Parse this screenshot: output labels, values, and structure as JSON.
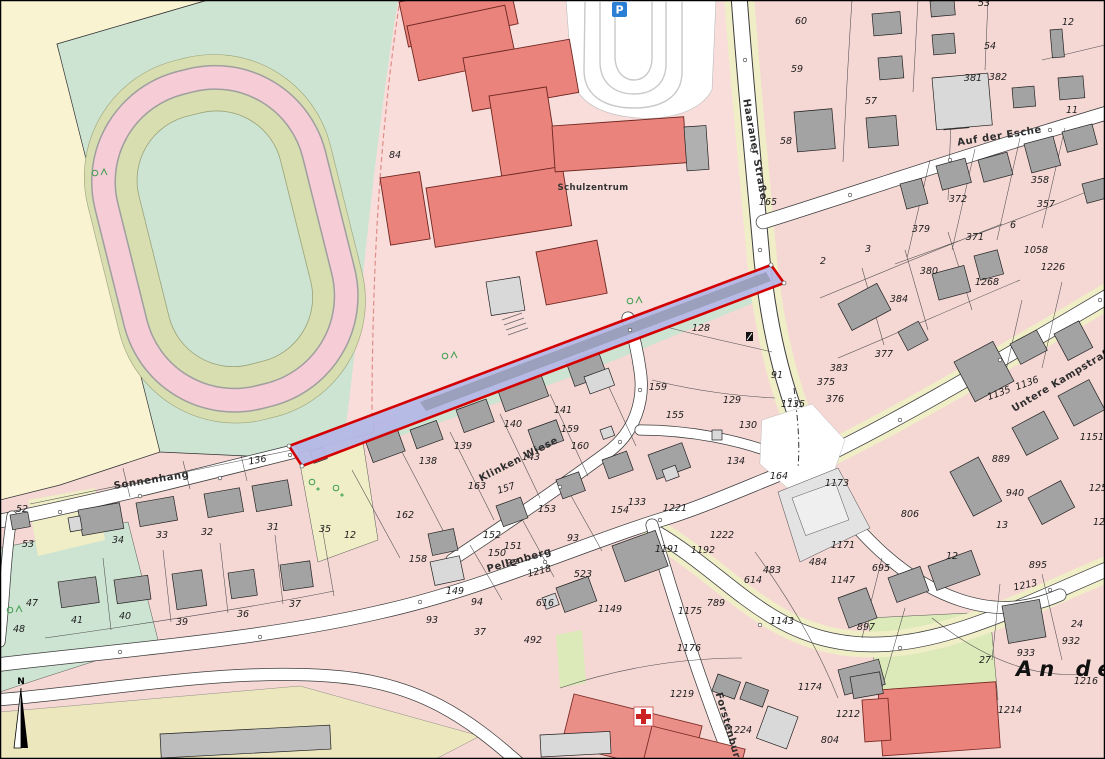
{
  "map": {
    "title": "cadastral-map",
    "palette": {
      "base_pink": "#f5d7d4",
      "mint_green": "#cde4d2",
      "olive_green": "#d8deaf",
      "track_pink": "#f6ccd6",
      "beige_field": "#faf3d2",
      "khaki": "#ece7bd",
      "pale_green": "#dce9b9",
      "building_gray": "#a3a3a3",
      "school_red": "#e9837b",
      "highlight_strip_blue": "#b4b8e6",
      "highlight_strip_border_red": "#d40000",
      "parking_icon_blue": "#2a7fd4",
      "hospital_cross_red": "#cc2222",
      "tree_green": "#3f9e4f"
    },
    "icons": {
      "parking_letter": "P",
      "north_letter": "N"
    },
    "street_labels": [
      {
        "t": "Sonnenhang",
        "x": 152,
        "y": 483,
        "r": -9
      },
      {
        "t": "Klinken Wiese",
        "x": 520,
        "y": 462,
        "r": -27
      },
      {
        "t": "Pellenberg",
        "x": 520,
        "y": 563,
        "r": -16
      },
      {
        "t": "Haaraner Straße",
        "x": 752,
        "y": 150,
        "r": 80
      },
      {
        "t": "Auf der Esche",
        "x": 1000,
        "y": 139,
        "r": -9
      },
      {
        "t": "Untere Kampstraße",
        "x": 1066,
        "y": 381,
        "r": -31
      },
      {
        "t": "Forstenburg",
        "x": 726,
        "y": 730,
        "r": 74
      }
    ],
    "area_labels": [
      {
        "t": "Schulzentrum",
        "x": 593,
        "y": 190,
        "r": 0
      }
    ],
    "big_label": {
      "t": "An der",
      "x": 1016,
      "y": 676
    },
    "parcel_labels": [
      {
        "t": "84",
        "x": 395,
        "y": 158
      },
      {
        "t": "165",
        "x": 768,
        "y": 205
      },
      {
        "t": "136",
        "x": 258,
        "y": 463,
        "r": -10
      },
      {
        "t": "52",
        "x": 22,
        "y": 512
      },
      {
        "t": "53",
        "x": 28,
        "y": 547
      },
      {
        "t": "34",
        "x": 118,
        "y": 543
      },
      {
        "t": "33",
        "x": 162,
        "y": 538
      },
      {
        "t": "32",
        "x": 207,
        "y": 535
      },
      {
        "t": "31",
        "x": 273,
        "y": 530
      },
      {
        "t": "35",
        "x": 325,
        "y": 532
      },
      {
        "t": "12",
        "x": 350,
        "y": 538
      },
      {
        "t": "47",
        "x": 32,
        "y": 606
      },
      {
        "t": "48",
        "x": 19,
        "y": 632
      },
      {
        "t": "41",
        "x": 77,
        "y": 623
      },
      {
        "t": "40",
        "x": 125,
        "y": 619
      },
      {
        "t": "39",
        "x": 182,
        "y": 625
      },
      {
        "t": "36",
        "x": 243,
        "y": 617
      },
      {
        "t": "37",
        "x": 295,
        "y": 607
      },
      {
        "t": "162",
        "x": 405,
        "y": 518
      },
      {
        "t": "163",
        "x": 477,
        "y": 489
      },
      {
        "t": "157",
        "x": 507,
        "y": 491,
        "r": -18
      },
      {
        "t": "153",
        "x": 547,
        "y": 512
      },
      {
        "t": "152",
        "x": 492,
        "y": 538
      },
      {
        "t": "151",
        "x": 513,
        "y": 549
      },
      {
        "t": "150",
        "x": 497,
        "y": 556
      },
      {
        "t": "92",
        "x": 512,
        "y": 566
      },
      {
        "t": "93",
        "x": 573,
        "y": 541
      },
      {
        "t": "1218",
        "x": 540,
        "y": 574,
        "r": -14
      },
      {
        "t": "138",
        "x": 428,
        "y": 464
      },
      {
        "t": "139",
        "x": 463,
        "y": 449
      },
      {
        "t": "140",
        "x": 513,
        "y": 427
      },
      {
        "t": "143",
        "x": 531,
        "y": 460
      },
      {
        "t": "141",
        "x": 563,
        "y": 413
      },
      {
        "t": "159",
        "x": 570,
        "y": 432
      },
      {
        "t": "160",
        "x": 580,
        "y": 449
      },
      {
        "t": "133",
        "x": 637,
        "y": 505
      },
      {
        "t": "154",
        "x": 620,
        "y": 513
      },
      {
        "t": "1221",
        "x": 675,
        "y": 511
      },
      {
        "t": "1222",
        "x": 722,
        "y": 538
      },
      {
        "t": "1191",
        "x": 667,
        "y": 552
      },
      {
        "t": "1192",
        "x": 703,
        "y": 553
      },
      {
        "t": "158",
        "x": 418,
        "y": 562
      },
      {
        "t": "149",
        "x": 455,
        "y": 594
      },
      {
        "t": "94",
        "x": 477,
        "y": 605
      },
      {
        "t": "93",
        "x": 432,
        "y": 623
      },
      {
        "t": "616",
        "x": 545,
        "y": 606
      },
      {
        "t": "523",
        "x": 583,
        "y": 577
      },
      {
        "t": "1149",
        "x": 610,
        "y": 612
      },
      {
        "t": "37",
        "x": 480,
        "y": 635
      },
      {
        "t": "492",
        "x": 533,
        "y": 643
      },
      {
        "t": "1176",
        "x": 689,
        "y": 651
      },
      {
        "t": "1219",
        "x": 682,
        "y": 697
      },
      {
        "t": "1224",
        "x": 740,
        "y": 733
      },
      {
        "t": "1175",
        "x": 690,
        "y": 614
      },
      {
        "t": "789",
        "x": 716,
        "y": 606
      },
      {
        "t": "1143",
        "x": 782,
        "y": 624
      },
      {
        "t": "1147",
        "x": 843,
        "y": 583
      },
      {
        "t": "614",
        "x": 753,
        "y": 583
      },
      {
        "t": "483",
        "x": 772,
        "y": 573
      },
      {
        "t": "484",
        "x": 818,
        "y": 565
      },
      {
        "t": "695",
        "x": 881,
        "y": 571
      },
      {
        "t": "897",
        "x": 866,
        "y": 630
      },
      {
        "t": "1213",
        "x": 1026,
        "y": 588,
        "r": -12
      },
      {
        "t": "24",
        "x": 1077,
        "y": 627
      },
      {
        "t": "932",
        "x": 1071,
        "y": 644
      },
      {
        "t": "933",
        "x": 1026,
        "y": 656
      },
      {
        "t": "27",
        "x": 985,
        "y": 663
      },
      {
        "t": "1216",
        "x": 1086,
        "y": 684
      },
      {
        "t": "1214",
        "x": 1010,
        "y": 713
      },
      {
        "t": "1212",
        "x": 848,
        "y": 717
      },
      {
        "t": "804",
        "x": 830,
        "y": 743
      },
      {
        "t": "1174",
        "x": 810,
        "y": 690
      },
      {
        "t": "60",
        "x": 801,
        "y": 24
      },
      {
        "t": "59",
        "x": 797,
        "y": 72
      },
      {
        "t": "57",
        "x": 871,
        "y": 104
      },
      {
        "t": "58",
        "x": 786,
        "y": 144
      },
      {
        "t": "53",
        "x": 984,
        "y": 6
      },
      {
        "t": "54",
        "x": 990,
        "y": 49
      },
      {
        "t": "12",
        "x": 1068,
        "y": 25
      },
      {
        "t": "381",
        "x": 973,
        "y": 81
      },
      {
        "t": "382",
        "x": 998,
        "y": 80
      },
      {
        "t": "11",
        "x": 1072,
        "y": 113
      },
      {
        "t": "358",
        "x": 1040,
        "y": 183
      },
      {
        "t": "357",
        "x": 1046,
        "y": 207
      },
      {
        "t": "372",
        "x": 958,
        "y": 202
      },
      {
        "t": "379",
        "x": 921,
        "y": 232
      },
      {
        "t": "371",
        "x": 975,
        "y": 240
      },
      {
        "t": "6",
        "x": 1013,
        "y": 228
      },
      {
        "t": "2",
        "x": 823,
        "y": 264
      },
      {
        "t": "3",
        "x": 868,
        "y": 252
      },
      {
        "t": "380",
        "x": 929,
        "y": 274
      },
      {
        "t": "384",
        "x": 899,
        "y": 302
      },
      {
        "t": "377",
        "x": 884,
        "y": 357
      },
      {
        "t": "383",
        "x": 839,
        "y": 371
      },
      {
        "t": "375",
        "x": 826,
        "y": 385
      },
      {
        "t": "376",
        "x": 835,
        "y": 402
      },
      {
        "t": "1058",
        "x": 1036,
        "y": 253
      },
      {
        "t": "1226",
        "x": 1053,
        "y": 270
      },
      {
        "t": "1268",
        "x": 987,
        "y": 285
      },
      {
        "t": "1135",
        "x": 793,
        "y": 407
      },
      {
        "t": "1135",
        "x": 1000,
        "y": 396,
        "r": -20
      },
      {
        "t": "1136",
        "x": 1028,
        "y": 386,
        "r": -20
      },
      {
        "t": "889",
        "x": 1001,
        "y": 462
      },
      {
        "t": "940",
        "x": 1015,
        "y": 496
      },
      {
        "t": "13",
        "x": 1002,
        "y": 528
      },
      {
        "t": "1151",
        "x": 1092,
        "y": 440
      },
      {
        "t": "125",
        "x": 1098,
        "y": 491
      },
      {
        "t": "12",
        "x": 1099,
        "y": 525
      },
      {
        "t": "806",
        "x": 910,
        "y": 517
      },
      {
        "t": "1171",
        "x": 843,
        "y": 548
      },
      {
        "t": "1173",
        "x": 837,
        "y": 486,
        "r": 0
      },
      {
        "t": "164",
        "x": 779,
        "y": 479
      },
      {
        "t": "895",
        "x": 1038,
        "y": 568
      },
      {
        "t": "12",
        "x": 952,
        "y": 559
      },
      {
        "t": "128",
        "x": 701,
        "y": 331
      },
      {
        "t": "91",
        "x": 777,
        "y": 378
      },
      {
        "t": "159",
        "x": 658,
        "y": 390
      },
      {
        "t": "155",
        "x": 675,
        "y": 418
      },
      {
        "t": "129",
        "x": 732,
        "y": 403
      },
      {
        "t": "130",
        "x": 748,
        "y": 428
      },
      {
        "t": "134",
        "x": 736,
        "y": 464
      }
    ]
  }
}
